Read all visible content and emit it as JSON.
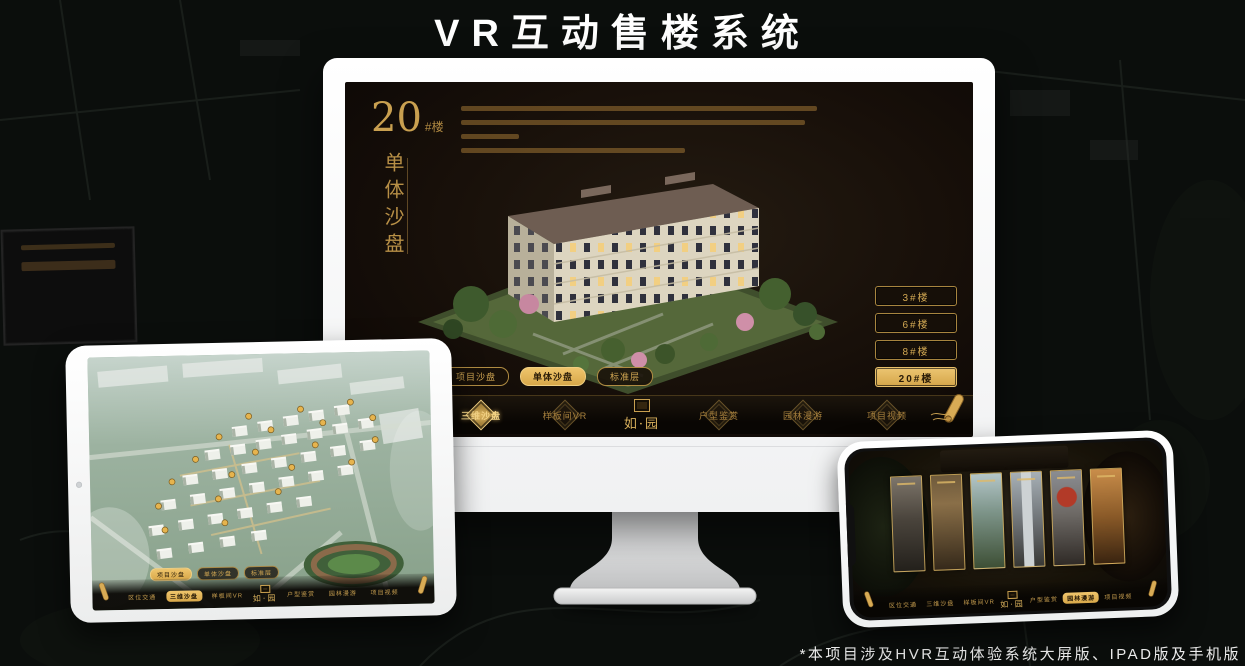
{
  "page": {
    "title": "VR互动售楼系统",
    "footnote": "*本项目涉及HVR互动体验系统大屏版、IPAD版及手机版"
  },
  "colors": {
    "gold": "#d2a853",
    "gold_bright": "#e8c06a",
    "screen_bg": "#16100a",
    "page_bg": "#0b0e0c"
  },
  "brand": {
    "logo_text": "如·园"
  },
  "monitor": {
    "building_label": {
      "number": "20",
      "suffix": "#楼"
    },
    "subtitle_vertical": "单体沙盘",
    "floor_buttons": [
      {
        "label": "3#楼",
        "active": false
      },
      {
        "label": "6#楼",
        "active": false
      },
      {
        "label": "8#楼",
        "active": false
      },
      {
        "label": "20#楼",
        "active": true
      }
    ],
    "view_tabs": [
      {
        "label": "项目沙盘",
        "active": false
      },
      {
        "label": "单体沙盘",
        "active": true
      },
      {
        "label": "标准层",
        "active": false
      }
    ],
    "nav": {
      "items": [
        {
          "label": "区位交通",
          "active": false
        },
        {
          "label": "三维沙盘",
          "active": true
        },
        {
          "label": "样板间VR",
          "active": false
        },
        {
          "label": "户型鉴赏",
          "active": false
        },
        {
          "label": "园林漫游",
          "active": false
        },
        {
          "label": "项目视频",
          "active": false
        }
      ]
    }
  },
  "tablet": {
    "view_tabs": [
      {
        "label": "项目沙盘",
        "active": true
      },
      {
        "label": "单体沙盘",
        "active": false
      },
      {
        "label": "标准层",
        "active": false
      }
    ],
    "nav": {
      "items": [
        {
          "label": "区位交通",
          "active": false
        },
        {
          "label": "三维沙盘",
          "active": true
        },
        {
          "label": "样板间VR",
          "active": false
        },
        {
          "label": "户型鉴赏",
          "active": false
        },
        {
          "label": "园林漫游",
          "active": false
        },
        {
          "label": "项目视频",
          "active": false
        }
      ]
    }
  },
  "phone": {
    "nav": {
      "items": [
        {
          "label": "区位交通",
          "active": false
        },
        {
          "label": "三维沙盘",
          "active": false
        },
        {
          "label": "样板间VR",
          "active": false
        },
        {
          "label": "户型鉴赏",
          "active": false
        },
        {
          "label": "园林漫游",
          "active": true
        },
        {
          "label": "项目视频",
          "active": false
        }
      ]
    }
  }
}
